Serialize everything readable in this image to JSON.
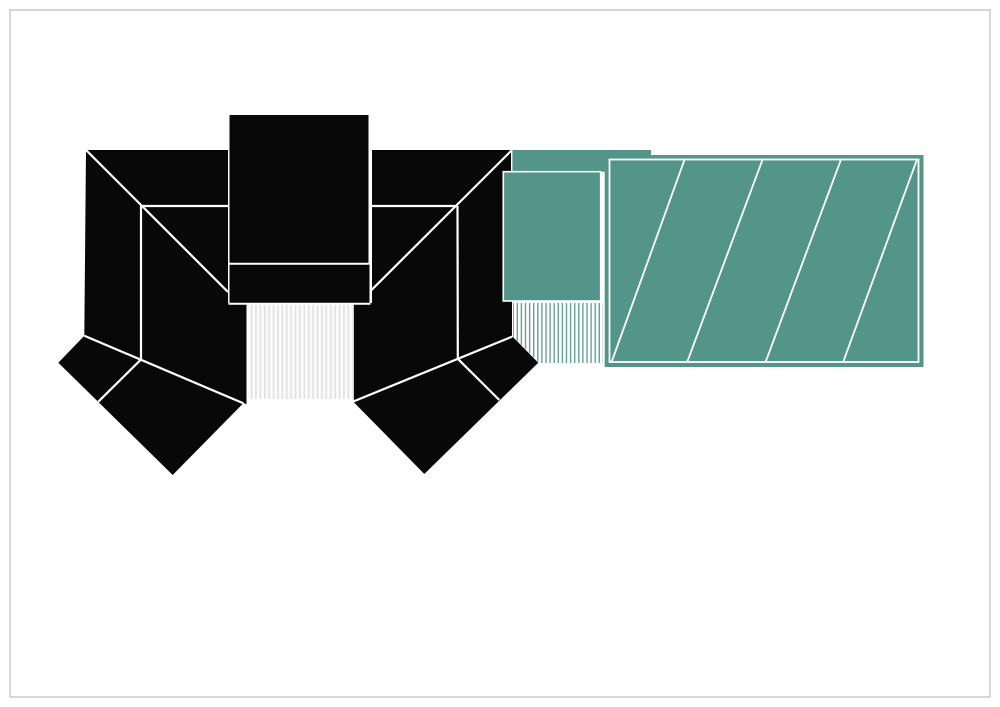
{
  "canvas": {
    "width": 1000,
    "height": 707,
    "background": "#ffffff"
  },
  "page_border": {
    "x": 10,
    "y": 10,
    "w": 980,
    "h": 687,
    "color": "#c9cccb",
    "stroke_width": 1.5
  },
  "colors": {
    "roof_black": "#080808",
    "teal": "#539689",
    "line_white": "#ffffff",
    "deck_bg_gray": "#fafafa",
    "deck_line_gray": "#dfe1e0",
    "deck_bg_teal": "#ffffff",
    "deck_line_teal": "#66a096"
  },
  "patterns": [
    {
      "id": "deck-gray",
      "spacing": 4.4,
      "bg": "deck_bg_gray",
      "line": "deck_line_gray",
      "line_width": 1.5
    },
    {
      "id": "deck-teal",
      "spacing": 4.1,
      "bg": "deck_bg_teal",
      "line": "deck_line_teal",
      "line_width": 1.4
    }
  ],
  "shapes": [
    {
      "type": "polygon",
      "name": "left-roof-block",
      "fill": "roof_black",
      "points": [
        [
          86,
          150
        ],
        [
          228,
          150
        ],
        [
          228,
          303
        ],
        [
          246.5,
          303
        ],
        [
          246.5,
          404.3
        ],
        [
          84.3,
          335.7
        ]
      ]
    },
    {
      "type": "rect",
      "name": "tower-roof",
      "fill": "roof_black",
      "x": 229.5,
      "y": 115,
      "w": 139,
      "h": 148
    },
    {
      "type": "rect",
      "name": "tower-band",
      "fill": "roof_black",
      "x": 229.5,
      "y": 264.5,
      "w": 140,
      "h": 38.5
    },
    {
      "type": "polygon",
      "name": "right-roof-block",
      "fill": "roof_black",
      "points": [
        [
          372,
          150
        ],
        [
          512,
          150
        ],
        [
          512,
          336.5
        ],
        [
          353.8,
          401.5
        ],
        [
          353.8,
          303
        ],
        [
          372,
          303
        ]
      ]
    },
    {
      "type": "polygon",
      "name": "left-angled-wing",
      "fill": "roof_black",
      "points": [
        [
          58.3,
          362.7
        ],
        [
          84.3,
          335.7
        ],
        [
          243.3,
          403.3
        ],
        [
          172.7,
          475
        ]
      ]
    },
    {
      "type": "polygon",
      "name": "right-angled-wing",
      "fill": "roof_black",
      "points": [
        [
          353.3,
          401.7
        ],
        [
          458.3,
          359.3
        ],
        [
          512.7,
          336.7
        ],
        [
          538.3,
          362.7
        ],
        [
          424.3,
          474
        ]
      ]
    },
    {
      "type": "rect",
      "name": "teal-back-roof",
      "fill": "teal",
      "stroke": "line_white",
      "stroke_width": 1.4,
      "x": 511.7,
      "y": 149.3,
      "w": 140,
      "h": 23.2
    },
    {
      "type": "rect",
      "name": "teal-front-roof",
      "fill": "teal",
      "stroke": "line_white",
      "stroke_width": 1.6,
      "x": 503.3,
      "y": 171.7,
      "w": 97.4,
      "h": 129.3
    },
    {
      "type": "rect",
      "name": "teal-hatched-roof",
      "fill": "teal",
      "x": 604.7,
      "y": 155,
      "w": 318.8,
      "h": 212
    },
    {
      "type": "rect",
      "name": "central-deck-stripes",
      "fill": "url:deck-gray",
      "x": 248.2,
      "y": 304.5,
      "w": 104.3,
      "h": 94.5
    },
    {
      "type": "polygon",
      "name": "teal-deck-stripes",
      "fill": "url:deck-teal",
      "points": [
        [
          513,
          303
        ],
        [
          603,
          303
        ],
        [
          603,
          363
        ],
        [
          539.5,
          363
        ],
        [
          513,
          336.5
        ]
      ]
    },
    {
      "type": "line",
      "name": "left-valley-line",
      "stroke": "line_white",
      "stroke_width": 2.2,
      "x1": 86,
      "y1": 150,
      "x2": 228,
      "y2": 292
    },
    {
      "type": "line",
      "name": "left-ridge-line",
      "stroke": "line_white",
      "stroke_width": 2.2,
      "x1": 141,
      "y1": 206,
      "x2": 228,
      "y2": 206
    },
    {
      "type": "line",
      "name": "left-hip-vertical",
      "stroke": "line_white",
      "stroke_width": 2.2,
      "x1": 141,
      "y1": 206,
      "x2": 141,
      "y2": 359.5
    },
    {
      "type": "line",
      "name": "left-eave-line",
      "stroke": "line_white",
      "stroke_width": 2.2,
      "x1": 84.3,
      "y1": 335.7,
      "x2": 243.3,
      "y2": 403.3
    },
    {
      "type": "line",
      "name": "left-wing-divider",
      "stroke": "line_white",
      "stroke_width": 2.2,
      "x1": 141,
      "y1": 359.5,
      "x2": 98.3,
      "y2": 401.7
    },
    {
      "type": "line",
      "name": "right-valley-line",
      "stroke": "line_white",
      "stroke_width": 2.2,
      "x1": 511.5,
      "y1": 150.5,
      "x2": 371,
      "y2": 290.5
    },
    {
      "type": "line",
      "name": "right-ridge-line",
      "stroke": "line_white",
      "stroke_width": 2.2,
      "x1": 372,
      "y1": 206,
      "x2": 457.5,
      "y2": 206
    },
    {
      "type": "line",
      "name": "right-hip-vertical",
      "stroke": "line_white",
      "stroke_width": 2.2,
      "x1": 457.5,
      "y1": 206,
      "x2": 457.8,
      "y2": 358.5
    },
    {
      "type": "line",
      "name": "right-eave-line",
      "stroke": "line_white",
      "stroke_width": 2.2,
      "x1": 353.3,
      "y1": 401.5,
      "x2": 512.2,
      "y2": 336.6
    },
    {
      "type": "line",
      "name": "right-wing-divider",
      "stroke": "line_white",
      "stroke_width": 2.2,
      "x1": 458.3,
      "y1": 359.3,
      "x2": 499.3,
      "y2": 400
    },
    {
      "type": "line",
      "name": "tower-band-line",
      "stroke": "line_white",
      "stroke_width": 2.0,
      "x1": 229.5,
      "y1": 263.8,
      "x2": 368.5,
      "y2": 263.8
    },
    {
      "type": "line",
      "name": "band-bottom-line",
      "stroke": "line_white",
      "stroke_width": 2.0,
      "x1": 228.5,
      "y1": 303.8,
      "x2": 370.5,
      "y2": 303.8
    },
    {
      "type": "rect-outline",
      "name": "hatched-roof-inner-border",
      "stroke": "line_white",
      "stroke_width": 1.8,
      "x": 609.5,
      "y": 159.5,
      "w": 309,
      "h": 202.5
    },
    {
      "type": "line",
      "name": "hatch-line-1",
      "stroke": "line_white",
      "stroke_width": 1.8,
      "x1": 611.7,
      "y1": 361.7,
      "x2": 684.3,
      "y2": 160.3
    },
    {
      "type": "line",
      "name": "hatch-line-2",
      "stroke": "line_white",
      "stroke_width": 1.8,
      "x1": 687.3,
      "y1": 361.7,
      "x2": 762.3,
      "y2": 160.3
    },
    {
      "type": "line",
      "name": "hatch-line-3",
      "stroke": "line_white",
      "stroke_width": 1.8,
      "x1": 765.7,
      "y1": 361.7,
      "x2": 840.7,
      "y2": 160.3
    },
    {
      "type": "line",
      "name": "hatch-line-4",
      "stroke": "line_white",
      "stroke_width": 1.8,
      "x1": 843.3,
      "y1": 361.7,
      "x2": 916.7,
      "y2": 160.3
    }
  ]
}
